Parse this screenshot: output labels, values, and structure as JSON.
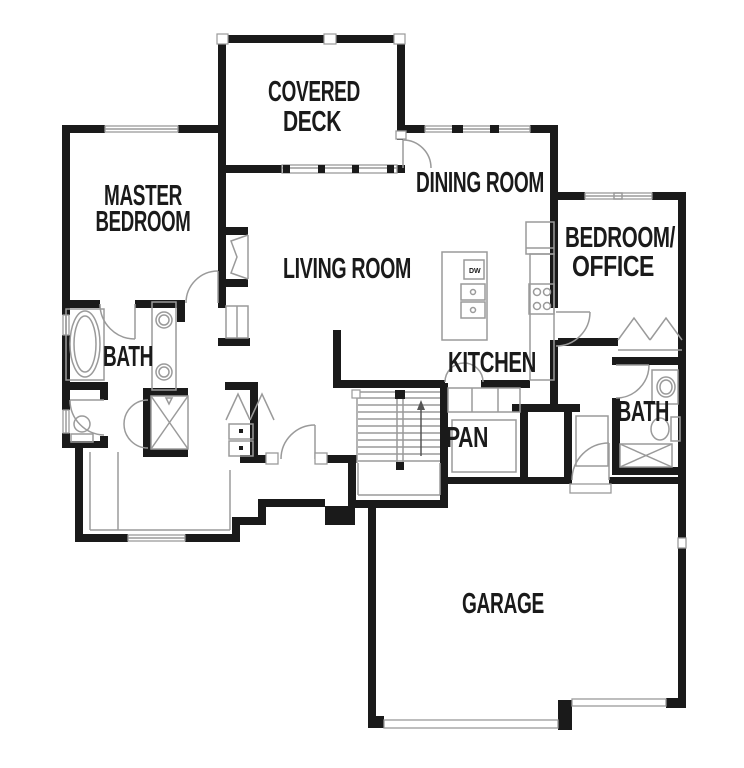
{
  "meta": {
    "type": "floor-plan",
    "stairs_direction": "up"
  },
  "colors": {
    "wall": "#1a1a1a",
    "line": "#9a9a9a",
    "bg": "#ffffff",
    "text": "#1a1a1a"
  },
  "rooms": [
    {
      "id": "covered-deck",
      "lines": [
        "COVERED",
        "DECK"
      ]
    },
    {
      "id": "master-bedroom",
      "lines": [
        "MASTER",
        "BEDROOM"
      ]
    },
    {
      "id": "dining-room",
      "lines": [
        "DINING ROOM"
      ]
    },
    {
      "id": "living-room",
      "lines": [
        "LIVING ROOM"
      ]
    },
    {
      "id": "bedroom-office",
      "lines": [
        "BEDROOM/",
        "OFFICE"
      ]
    },
    {
      "id": "master-bath",
      "lines": [
        "BATH"
      ]
    },
    {
      "id": "kitchen",
      "lines": [
        "KITCHEN"
      ]
    },
    {
      "id": "pantry",
      "lines": [
        "PAN"
      ]
    },
    {
      "id": "hall-bath",
      "lines": [
        "BATH"
      ]
    },
    {
      "id": "garage",
      "lines": [
        "GARAGE"
      ]
    }
  ],
  "kitchen": {
    "dw_label": "DW"
  },
  "fixtures": [
    "bathtub",
    "double-vanity-sinks",
    "toilet",
    "shower",
    "washer-dryer",
    "kitchen-island",
    "dishwasher",
    "double-sink",
    "range",
    "refrigerator",
    "stairs-up",
    "fireplace",
    "garage-doors",
    "bifold-closet-doors"
  ]
}
